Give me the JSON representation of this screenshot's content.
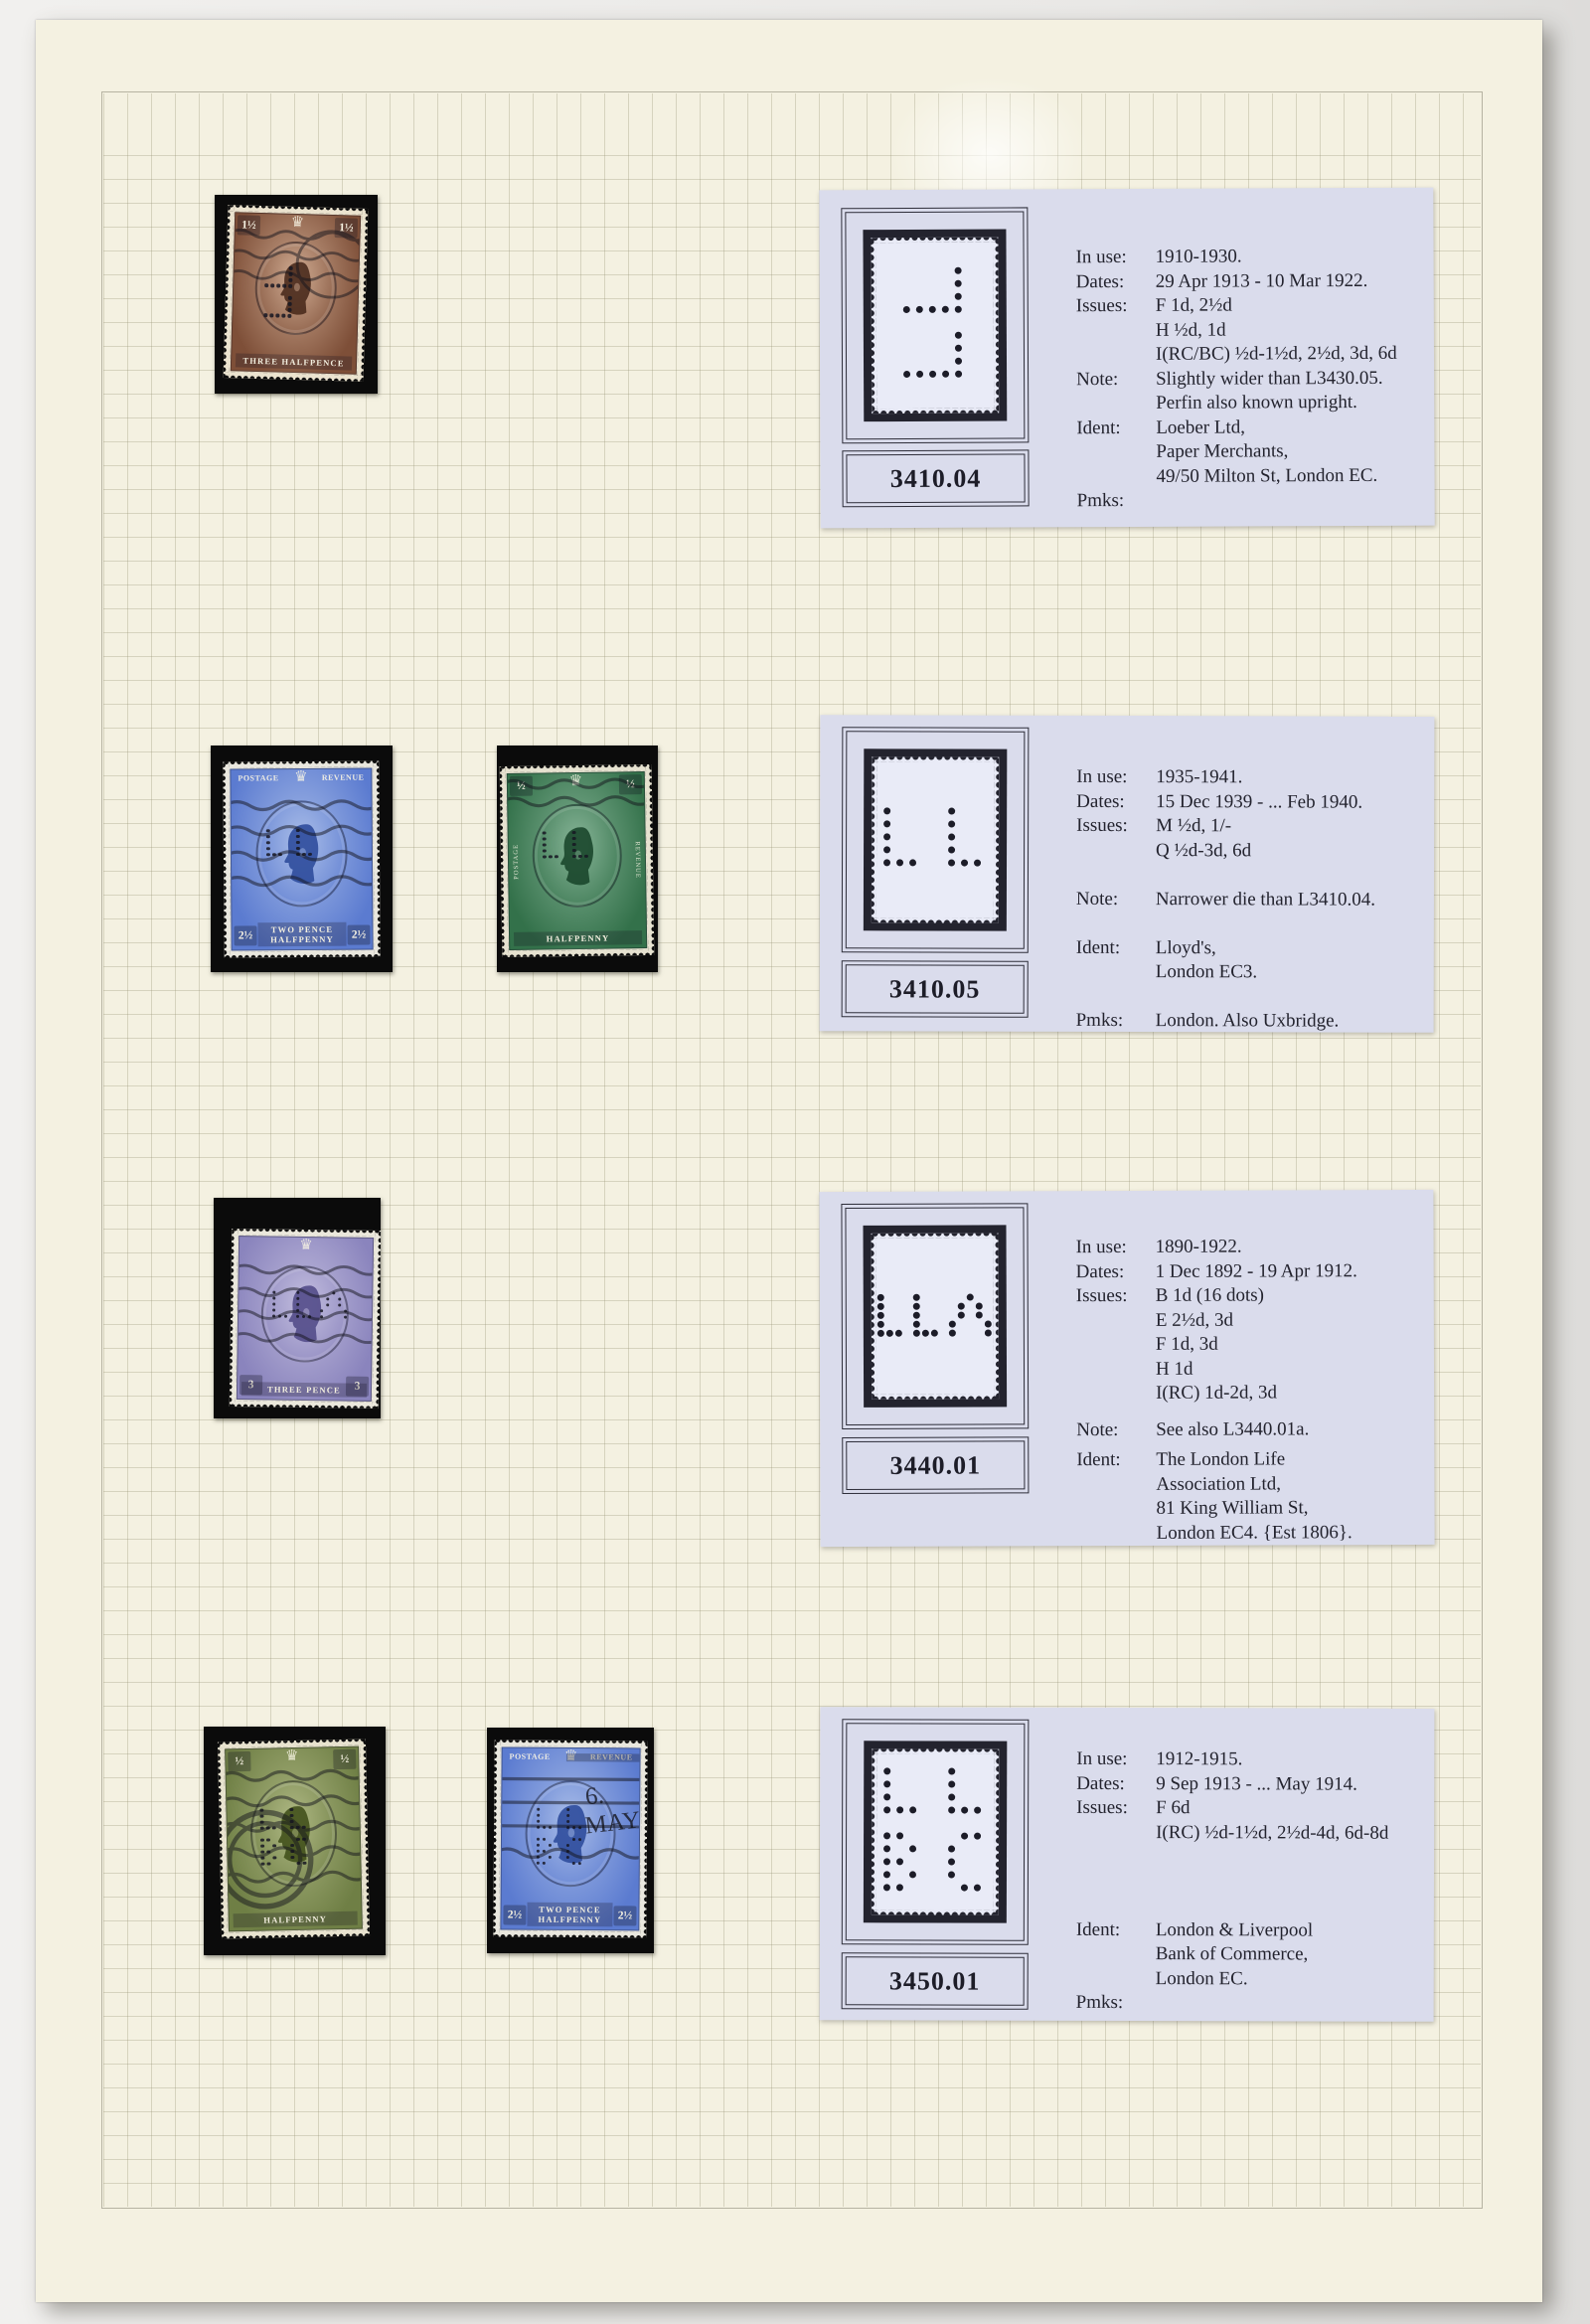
{
  "colors": {
    "page_background": "#f4f1e1",
    "card_background": "#dadcec",
    "mount_black": "#0b0b0b",
    "ink": "#23232e"
  },
  "perfin_patterns": {
    "p1": [
      "....#",
      "....#",
      "....#",
      "#####",
      ".....",
      "....#",
      "....#",
      "....#",
      "#####"
    ],
    "p2": [
      "#....#..",
      "#....#..",
      "#....#..",
      "#....#..",
      "###..###"
    ],
    "p3": [
      "#...#.....#..",
      "#...#....#.#.",
      "#...#....#.#.",
      "#...#...#...#",
      "###.###.#...#"
    ],
    "p4": [
      "#....#..",
      "#....#..",
      "#....#..",
      "###..###",
      "........",
      "##....##",
      "#.#..#..",
      "##...#..",
      "#.#..#..",
      "##....##"
    ]
  },
  "cards": [
    {
      "number": "3410.04",
      "perfin": "p1",
      "fields": [
        {
          "label": "In use:",
          "gap": 0,
          "lines": [
            "1910-1930."
          ]
        },
        {
          "label": "Dates:",
          "gap": 0,
          "lines": [
            "29 Apr 1913 - 10 Mar 1922."
          ]
        },
        {
          "label": "Issues:",
          "gap": 0,
          "lines": [
            "F 1d, 2½d",
            "H ½d, 1d",
            "I(RC/BC) ½d-1½d, 2½d, 3d, 6d"
          ]
        },
        {
          "label": "Note:",
          "gap": 0,
          "lines": [
            "Slightly wider than L3430.05.",
            "Perfin also known upright."
          ]
        },
        {
          "label": "Ident:",
          "gap": 0,
          "lines": [
            "Loeber Ltd,",
            "Paper Merchants,",
            "49/50 Milton St, London EC."
          ]
        },
        {
          "label": "Pmks:",
          "gap": 0,
          "lines": []
        }
      ]
    },
    {
      "number": "3410.05",
      "perfin": "p2",
      "fields": [
        {
          "label": "In use:",
          "gap": 0,
          "lines": [
            "1935-1941."
          ]
        },
        {
          "label": "Dates:",
          "gap": 0,
          "lines": [
            "15 Dec 1939 - ... Feb 1940."
          ]
        },
        {
          "label": "Issues:",
          "gap": 0,
          "lines": [
            "M ½d, 1/-",
            "Q ½d-3d, 6d"
          ]
        },
        {
          "label": "Note:",
          "gap": 1,
          "lines": [
            "Narrower die than L3410.04."
          ]
        },
        {
          "label": "Ident:",
          "gap": 1,
          "lines": [
            "Lloyd's,",
            "London EC3."
          ]
        },
        {
          "label": "Pmks:",
          "gap": 1,
          "lines": [
            "London.  Also Uxbridge."
          ]
        }
      ]
    },
    {
      "number": "3440.01",
      "perfin": "p3",
      "fields": [
        {
          "label": "In use:",
          "gap": 0,
          "lines": [
            "1890-1922."
          ]
        },
        {
          "label": "Dates:",
          "gap": 0,
          "lines": [
            "1 Dec 1892 - 19 Apr 1912."
          ]
        },
        {
          "label": "Issues:",
          "gap": 0,
          "lines": [
            "B 1d (16 dots)",
            "E 2½d, 3d",
            "F 1d, 3d",
            "H 1d",
            "I(RC) 1d-2d, 3d"
          ]
        },
        {
          "label": "Note:",
          "gap": 0.5,
          "lines": [
            "See also L3440.01a."
          ]
        },
        {
          "label": "Ident:",
          "gap": 0.25,
          "lines": [
            "The London Life",
            "Association Ltd,",
            "81 King William St,",
            "London EC4.  {Est 1806}."
          ]
        }
      ]
    },
    {
      "number": "3450.01",
      "perfin": "p4",
      "fields": [
        {
          "label": "In use:",
          "gap": 0,
          "lines": [
            "1912-1915."
          ]
        },
        {
          "label": "Dates:",
          "gap": 0,
          "lines": [
            "9 Sep 1913 - ... May 1914."
          ]
        },
        {
          "label": "Issues:",
          "gap": 0,
          "lines": [
            "F 6d",
            "I(RC) ½d-1½d, 2½d-4d, 6d-8d"
          ]
        },
        {
          "label": "Ident:",
          "gap": 3,
          "lines": [
            "London & Liverpool",
            "Bank of Commerce,",
            "London EC."
          ]
        },
        {
          "label": "Pmks:",
          "gap": 0,
          "lines": []
        }
      ]
    }
  ],
  "stamps": [
    {
      "id": "brown-three-halfpence",
      "colors": {
        "main": "#7e4f38",
        "deep": "#4a2b1d",
        "light": "#c9a48b",
        "paper": "#ebe3cf"
      },
      "value_pos": "top",
      "value_left": "1½",
      "value_right": "1½",
      "banners": null,
      "side_banners": null,
      "bottom_lines": [
        "THREE HALFPENCE"
      ],
      "cancel": "wavy-light",
      "cancel_text": null,
      "perfin": "p1"
    },
    {
      "id": "blue-twopence-halfpenny-a",
      "colors": {
        "main": "#5b7bd0",
        "deep": "#2f4d9c",
        "light": "#a2b7e6",
        "paper": "#e9e7de"
      },
      "value_pos": "bottom",
      "value_left": "2½",
      "value_right": "2½",
      "banners": [
        "POSTAGE",
        "REVENUE"
      ],
      "side_banners": null,
      "bottom_lines": [
        "TWO PENCE",
        "HALFPENNY"
      ],
      "cancel": "wavy",
      "cancel_text": null,
      "perfin": "p2"
    },
    {
      "id": "green-halfpenny-photogravure",
      "colors": {
        "main": "#33714a",
        "deep": "#1b472c",
        "light": "#7fae90",
        "paper": "#e6e2d0"
      },
      "value_pos": "top",
      "value_left": "½",
      "value_right": "½",
      "banners": null,
      "side_banners": [
        "POSTAGE",
        "REVENUE"
      ],
      "bottom_lines": [
        "HALFPENNY"
      ],
      "cancel": "top",
      "cancel_text": null,
      "perfin": "p2"
    },
    {
      "id": "violet-three-pence",
      "colors": {
        "main": "#8a84bd",
        "deep": "#534d8a",
        "light": "#bdb8db",
        "paper": "#ebe8dc"
      },
      "value_pos": "bottom",
      "value_left": "3",
      "value_right": "3",
      "banners": null,
      "side_banners": null,
      "bottom_lines": [
        "THREE PENCE"
      ],
      "cancel": "wavy",
      "cancel_text": null,
      "perfin": "p3"
    },
    {
      "id": "olive-green-halfpenny",
      "colors": {
        "main": "#6f7f45",
        "deep": "#42511c",
        "light": "#a9b37e",
        "paper": "#e8e3cf"
      },
      "value_pos": "top",
      "value_left": "½",
      "value_right": "½",
      "banners": null,
      "side_banners": null,
      "bottom_lines": [
        "HALFPENNY"
      ],
      "cancel": "heavy",
      "cancel_text": null,
      "perfin": "p4"
    },
    {
      "id": "blue-twopence-halfpenny-b",
      "colors": {
        "main": "#5b7bd0",
        "deep": "#2f4d9c",
        "light": "#a2b7e6",
        "paper": "#e9e7de"
      },
      "value_pos": "bottom",
      "value_left": "2½",
      "value_right": "2½",
      "banners": [
        "POSTAGE",
        "REVENUE"
      ],
      "side_banners": null,
      "bottom_lines": [
        "TWO PENCE",
        "HALFPENNY"
      ],
      "cancel": "bars",
      "cancel_text": [
        "6.",
        "MAY"
      ],
      "perfin": "p4"
    }
  ]
}
